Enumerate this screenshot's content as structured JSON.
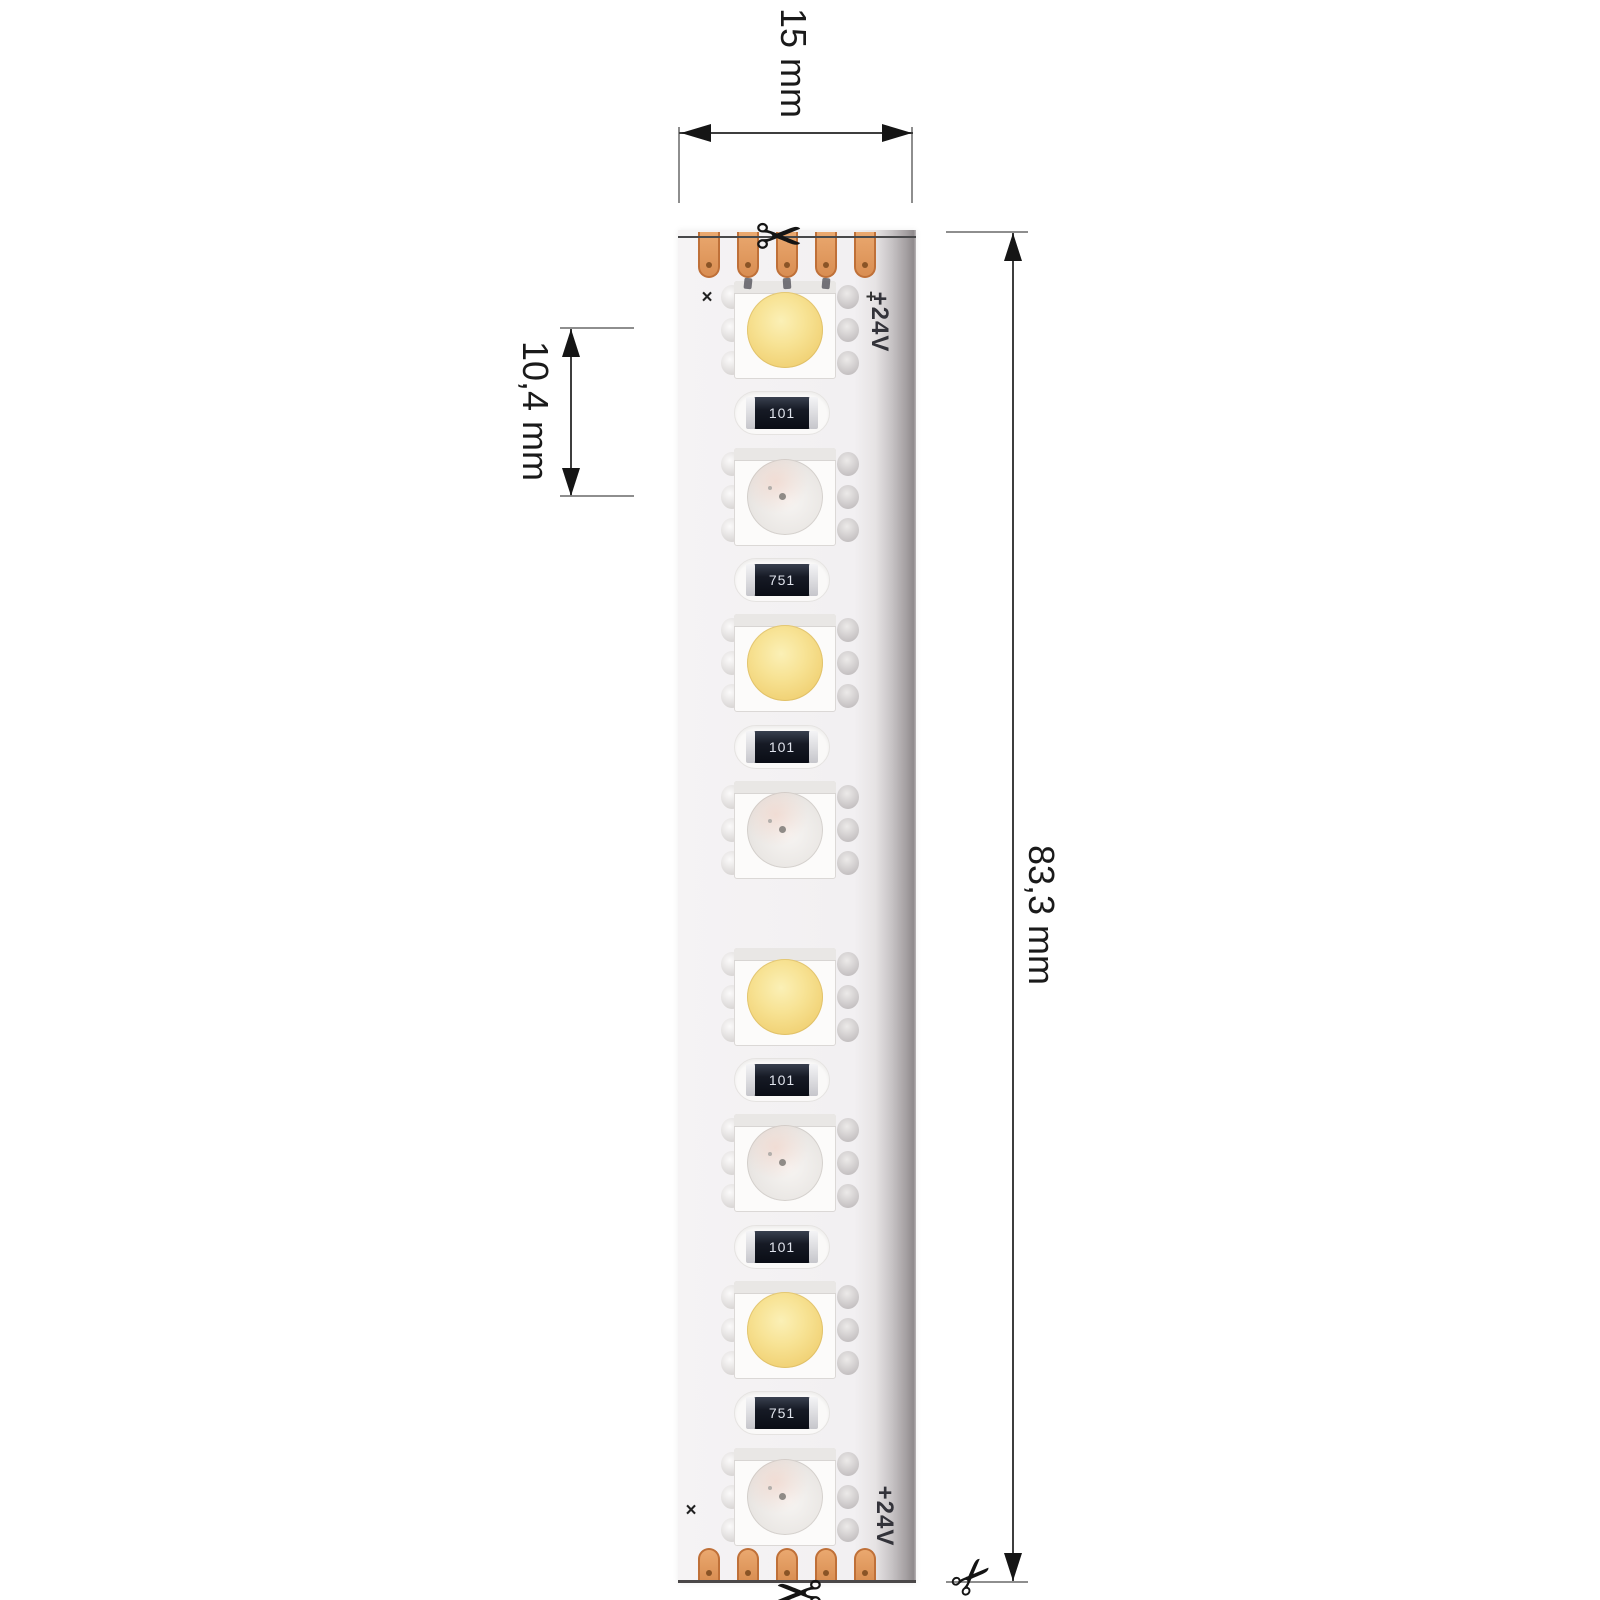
{
  "dimensions": {
    "width_label": "15 mm",
    "pitch_label": "10,4 mm",
    "length_label": "83,3 mm"
  },
  "strip": {
    "voltage_marking": "+24V",
    "cut_cross_marking": "×",
    "plus_marking": "+",
    "top_pad_count": 5,
    "bottom_pad_count": 5,
    "components": [
      {
        "type": "led-white",
        "y": 330
      },
      {
        "type": "resistor",
        "y": 413,
        "label": "101"
      },
      {
        "type": "led-rgb",
        "y": 497
      },
      {
        "type": "resistor",
        "y": 580,
        "label": "751"
      },
      {
        "type": "led-white",
        "y": 663
      },
      {
        "type": "resistor",
        "y": 747,
        "label": "101"
      },
      {
        "type": "led-rgb",
        "y": 830
      },
      {
        "type": "led-white",
        "y": 997
      },
      {
        "type": "resistor",
        "y": 1080,
        "label": "101"
      },
      {
        "type": "led-rgb",
        "y": 1163
      },
      {
        "type": "resistor",
        "y": 1247,
        "label": "101"
      },
      {
        "type": "led-white",
        "y": 1330
      },
      {
        "type": "resistor",
        "y": 1413,
        "label": "751"
      },
      {
        "type": "led-rgb",
        "y": 1497
      }
    ]
  },
  "icons": {
    "scissors_glyph": "✂"
  },
  "colors": {
    "copper_pad": "#d98e52",
    "warm_white_led": "#f1d276",
    "pcb_shadow": "#8f8a8c",
    "dimension_line": "#3e3e3e"
  }
}
